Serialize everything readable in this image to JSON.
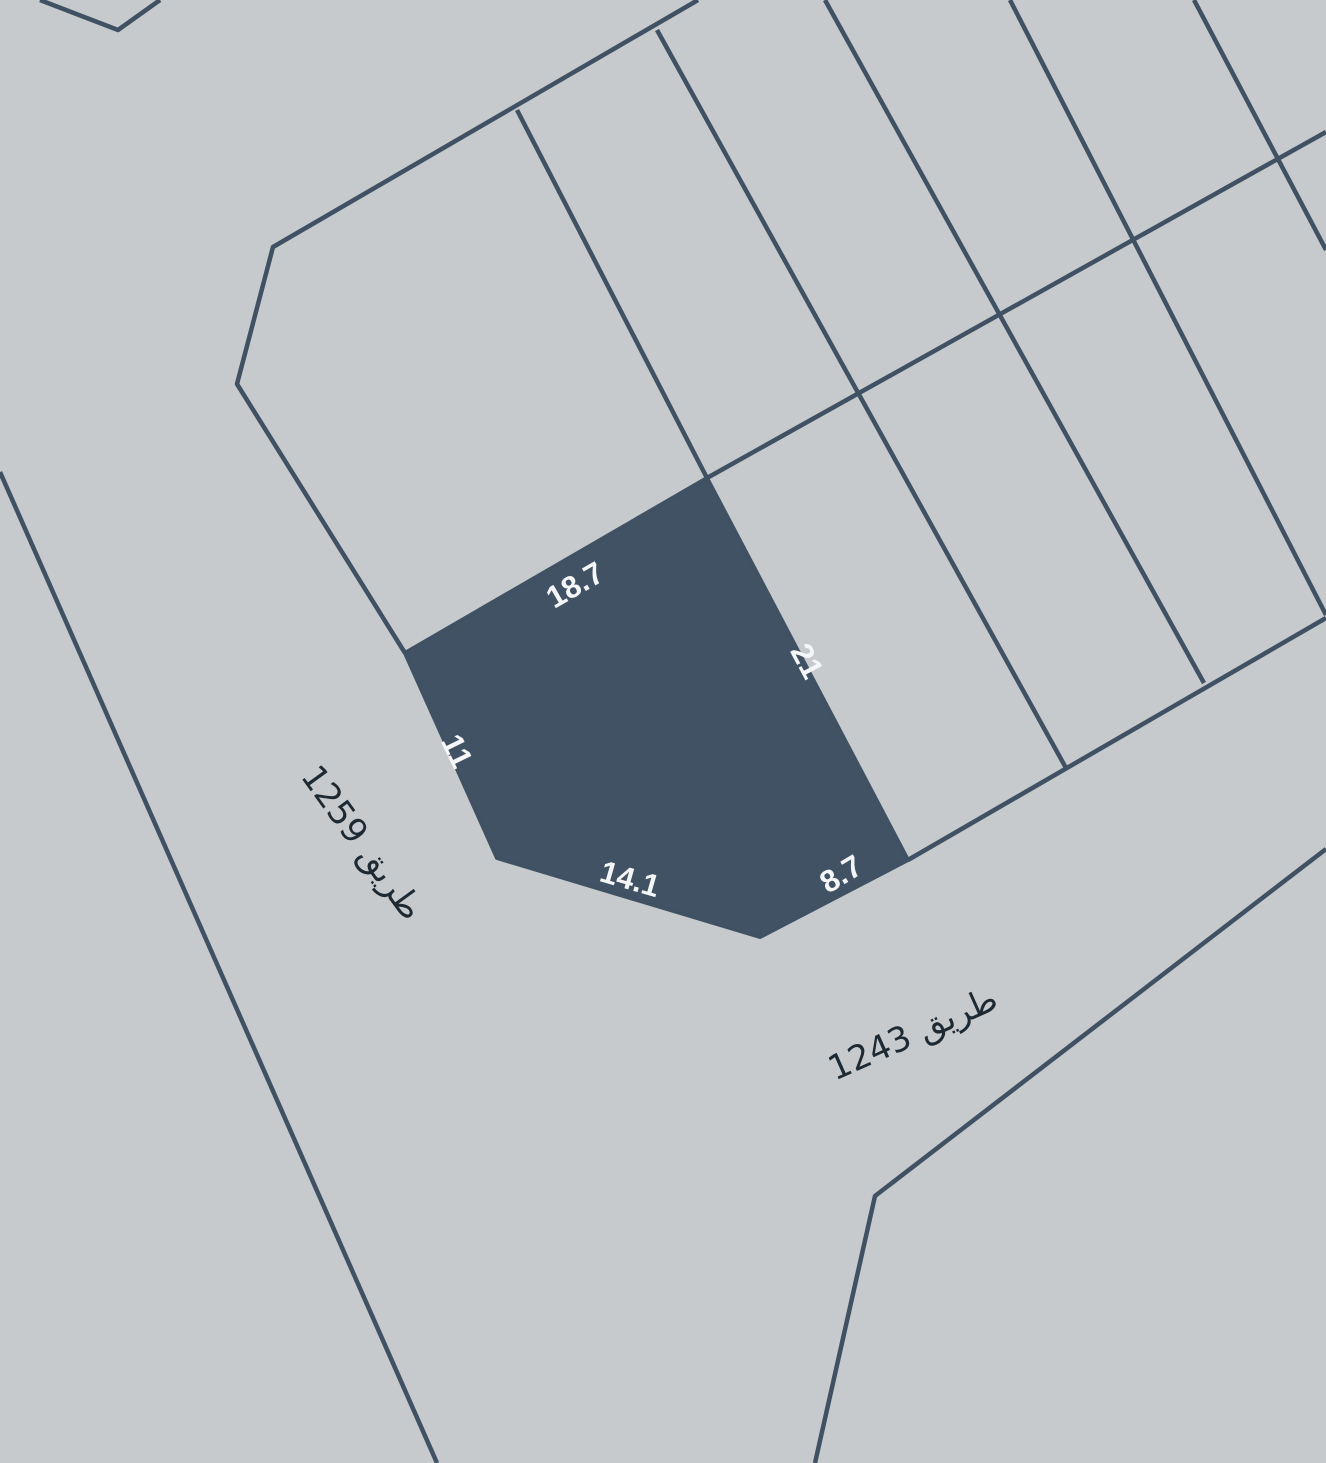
{
  "map": {
    "background_color": "#c6cacd",
    "boundary_color": "#3f5163",
    "selected_parcel": {
      "fill_color": "#405264",
      "label_color": "#f4f6f8",
      "edge_labels": [
        {
          "side": "northwest",
          "value": "18.7"
        },
        {
          "side": "east",
          "value": "21"
        },
        {
          "side": "west",
          "value": "11"
        },
        {
          "side": "south",
          "value": "14.1"
        },
        {
          "side": "southeast",
          "value": "8.7"
        }
      ]
    },
    "street_label_color": "#1e2a33",
    "streets": [
      {
        "name": "طريق 1259"
      },
      {
        "name": "طريق 1243"
      }
    ]
  }
}
